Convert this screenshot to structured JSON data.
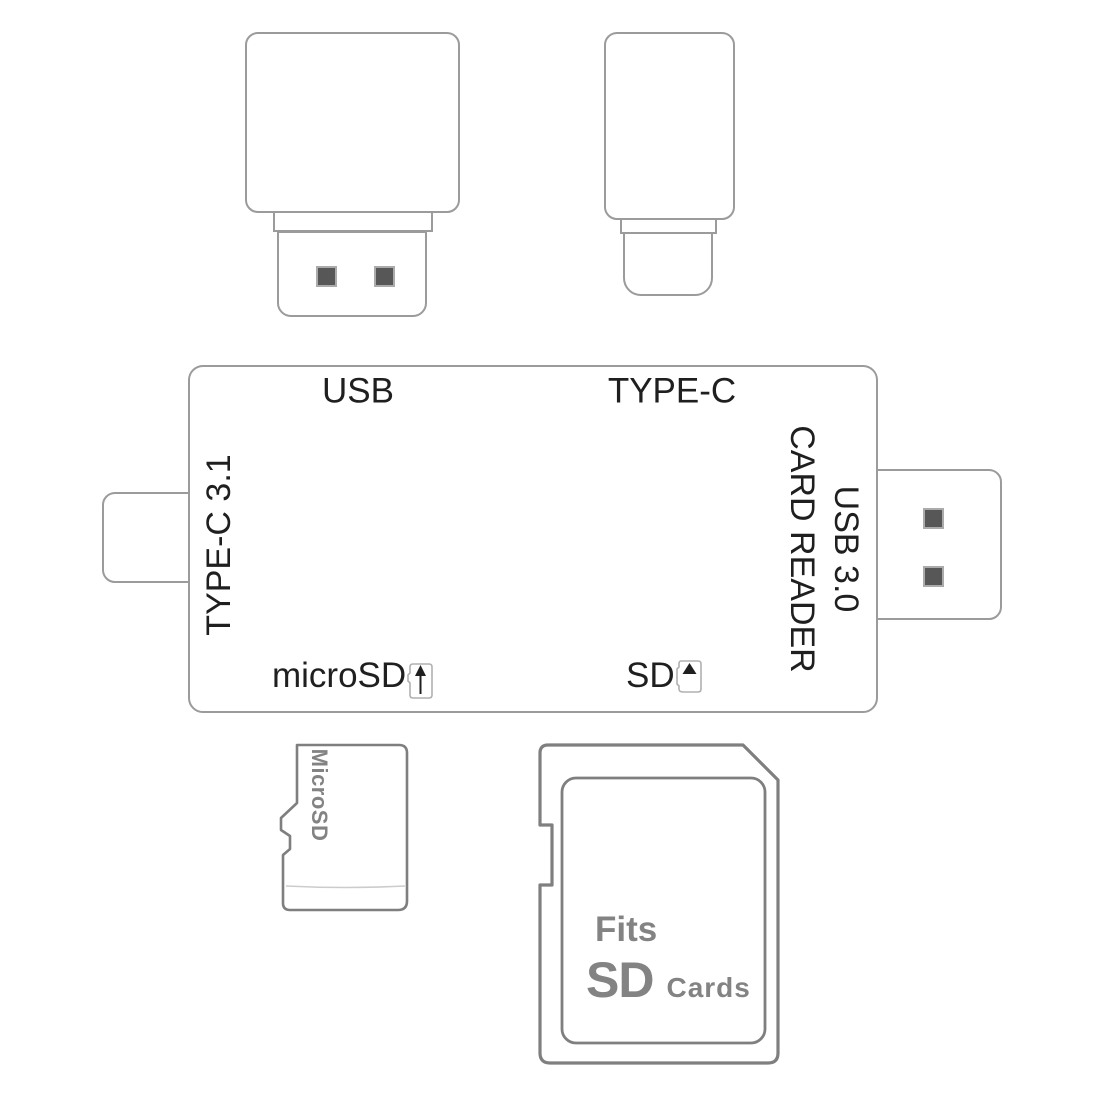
{
  "reader": {
    "label_usb": "USB",
    "label_type_c": "TYPE-C",
    "label_left_side": "TYPE-C 3.1",
    "label_right_line1": "USB 3.0",
    "label_right_line2": "CARD READER",
    "label_micro_sd_slot": "microSD",
    "label_sd_slot": "SD"
  },
  "micro_sd_card": {
    "label": "MicroSD"
  },
  "sd_card": {
    "line1": "Fits",
    "line2_big": "SD",
    "line2_small": "Cards"
  },
  "icons": {
    "micro_sd_slot_icon": "mini-card-with-up-arrow",
    "sd_slot_icon": "mini-card-with-solid-up-triangle",
    "usb_contacts": "two-dark-squares"
  },
  "colors": {
    "device_outline": "#9b9b9b",
    "card_outline": "#7f7f7f",
    "label_text": "#1f1f1f",
    "card_text": "#838383",
    "contact_fill": "#575757"
  }
}
